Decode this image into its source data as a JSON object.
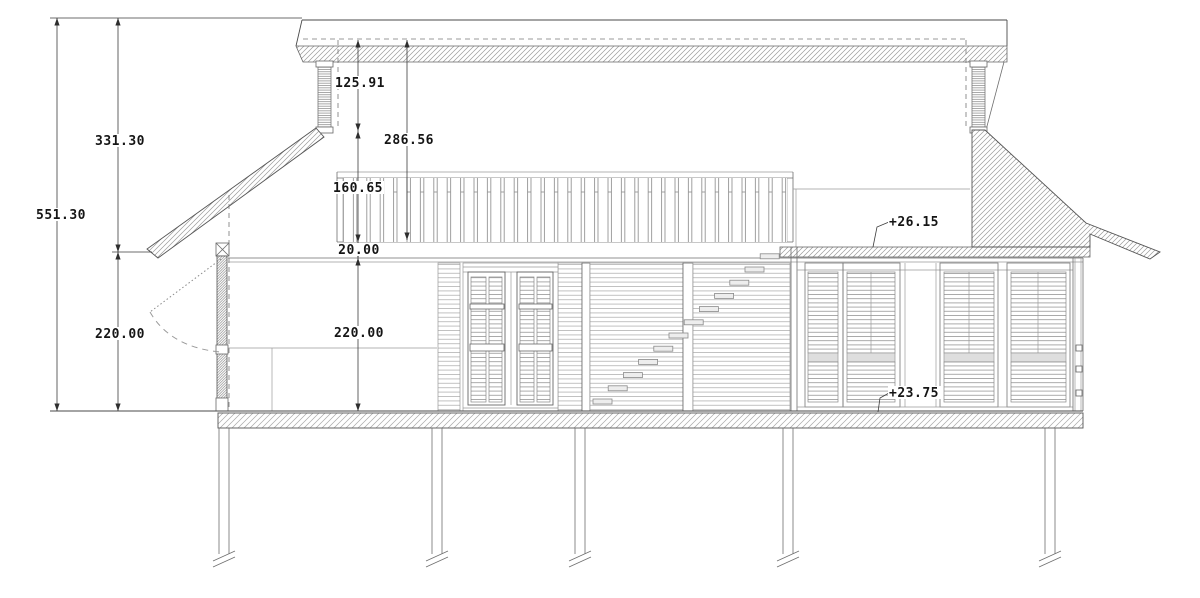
{
  "annotations": {
    "overall_height": "551.30",
    "upper_zone_height": "331.30",
    "left_wall_height": "220.00",
    "clerestory_upper": "125.91",
    "clerestory_overall": "286.56",
    "clerestory_band": "160.65",
    "roof_edge_thickness": "20.00",
    "interior_clear_height": "220.00",
    "eave_level": "+26.15",
    "floor_level": "+23.75"
  }
}
